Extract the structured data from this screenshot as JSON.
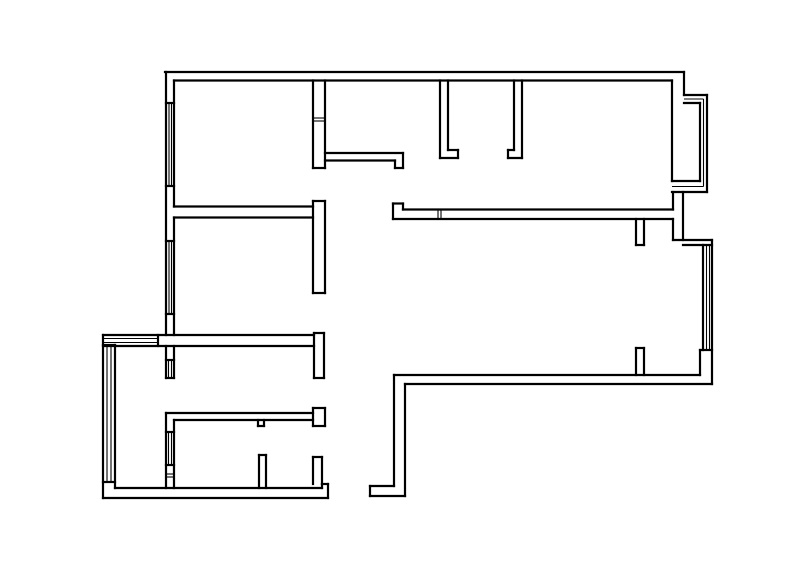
{
  "meta": {
    "description": "Residential apartment floor plan line drawing, black walls on white background",
    "background_color": "#ffffff"
  },
  "canvas": {
    "width": 800,
    "height": 563
  },
  "style": {
    "wall_color": "#000000",
    "wall_stroke_width": 2.2,
    "glazing_color": "#000000",
    "glazing_stroke_width": 1.1
  },
  "floor_plan": {
    "wall_segments": [
      [
        165,
        72,
        684,
        72
      ],
      [
        174,
        80.5,
        672,
        80.5
      ],
      [
        166,
        72,
        166,
        335
      ],
      [
        174,
        80.5,
        174,
        206.5
      ],
      [
        174,
        217.5,
        174,
        335
      ],
      [
        166,
        103,
        174,
        103
      ],
      [
        166,
        186,
        174,
        186
      ],
      [
        166,
        241,
        174,
        241
      ],
      [
        166,
        314,
        174,
        314
      ],
      [
        174,
        206.5,
        313,
        206.5
      ],
      [
        174,
        217.5,
        313,
        217.5
      ],
      [
        313,
        201,
        313,
        293
      ],
      [
        325,
        201,
        325,
        293
      ],
      [
        313,
        201,
        325,
        201
      ],
      [
        313,
        293,
        325,
        293
      ],
      [
        313,
        80.5,
        313,
        168
      ],
      [
        325,
        80.5,
        325,
        168
      ],
      [
        313,
        168,
        325,
        168
      ],
      [
        325,
        153,
        403,
        153
      ],
      [
        325,
        160.5,
        395,
        160.5
      ],
      [
        395,
        160.5,
        395,
        168
      ],
      [
        395,
        168,
        403,
        168
      ],
      [
        403,
        153,
        403,
        168
      ],
      [
        440,
        80.5,
        440,
        158
      ],
      [
        448,
        80.5,
        448,
        150
      ],
      [
        448,
        150,
        458,
        150
      ],
      [
        458,
        150,
        458,
        158
      ],
      [
        440,
        158,
        458,
        158
      ],
      [
        522,
        80.5,
        522,
        158
      ],
      [
        514,
        80.5,
        514,
        150
      ],
      [
        508,
        150,
        514,
        150
      ],
      [
        508,
        150,
        508,
        158
      ],
      [
        508,
        158,
        522,
        158
      ],
      [
        393,
        203.5,
        403,
        203.5
      ],
      [
        393,
        203.5,
        393,
        219
      ],
      [
        403,
        203.5,
        403,
        209.5
      ],
      [
        403,
        209.5,
        673,
        209.5
      ],
      [
        393,
        219,
        673,
        219
      ],
      [
        636,
        219,
        636,
        245
      ],
      [
        644,
        219,
        644,
        245
      ],
      [
        636,
        245,
        644,
        245
      ],
      [
        684,
        72,
        684,
        95
      ],
      [
        672,
        80.5,
        672,
        181
      ],
      [
        684,
        95,
        707,
        95
      ],
      [
        707,
        95,
        707,
        192
      ],
      [
        672,
        192,
        707,
        192
      ],
      [
        684,
        103,
        700,
        103
      ],
      [
        700,
        103,
        700,
        181
      ],
      [
        672,
        181,
        700,
        181
      ],
      [
        673,
        192,
        673,
        209.5
      ],
      [
        673,
        219,
        673,
        240
      ],
      [
        683,
        192,
        683,
        240
      ],
      [
        673,
        240,
        712,
        240
      ],
      [
        683,
        245,
        712,
        245
      ],
      [
        712,
        240,
        712,
        384
      ],
      [
        703,
        245,
        703,
        350
      ],
      [
        700,
        350,
        712,
        350
      ],
      [
        700,
        350,
        700,
        375
      ],
      [
        394,
        375,
        700,
        375
      ],
      [
        405,
        384,
        712,
        384
      ],
      [
        636,
        348,
        636,
        375
      ],
      [
        644,
        348,
        644,
        375
      ],
      [
        636,
        348,
        644,
        348
      ],
      [
        394,
        375,
        394,
        486
      ],
      [
        405,
        384,
        405,
        496
      ],
      [
        370,
        486,
        394,
        486
      ],
      [
        370,
        496,
        405,
        496
      ],
      [
        370,
        486,
        370,
        496
      ],
      [
        103,
        335,
        314,
        335
      ],
      [
        103,
        346,
        314,
        346
      ],
      [
        158,
        335,
        158,
        346
      ],
      [
        314,
        333,
        314,
        378
      ],
      [
        324,
        333,
        324,
        378
      ],
      [
        314,
        333,
        324,
        333
      ],
      [
        314,
        378,
        324,
        378
      ],
      [
        166,
        346,
        166,
        378
      ],
      [
        174,
        346,
        174,
        378
      ],
      [
        166,
        360,
        174,
        360
      ],
      [
        166,
        378,
        174,
        378
      ],
      [
        103,
        335,
        103,
        498
      ],
      [
        115,
        345,
        115,
        488
      ],
      [
        103,
        345,
        115,
        345
      ],
      [
        103,
        482,
        115,
        482
      ],
      [
        103,
        498,
        328,
        498
      ],
      [
        115,
        488,
        322,
        488
      ],
      [
        322,
        484,
        328,
        484
      ],
      [
        322,
        484,
        322,
        488
      ],
      [
        328,
        484,
        328,
        498
      ],
      [
        259,
        455,
        259,
        488
      ],
      [
        266,
        455,
        266,
        488
      ],
      [
        259,
        455,
        266,
        455
      ],
      [
        313,
        457,
        313,
        484
      ],
      [
        322,
        457,
        322,
        484
      ],
      [
        313,
        457,
        322,
        457
      ],
      [
        166,
        413,
        313,
        413
      ],
      [
        174,
        420,
        313,
        420
      ],
      [
        166,
        413,
        166,
        488
      ],
      [
        174,
        420,
        174,
        488
      ],
      [
        166,
        432,
        174,
        432
      ],
      [
        166,
        465,
        174,
        465
      ],
      [
        258,
        420,
        258,
        426
      ],
      [
        264,
        420,
        264,
        426
      ],
      [
        258,
        426,
        264,
        426
      ],
      [
        313,
        408,
        313,
        426
      ],
      [
        325,
        408,
        325,
        426
      ],
      [
        313,
        408,
        325,
        408
      ],
      [
        313,
        426,
        325,
        426
      ]
    ],
    "glazing_segments": [
      [
        169,
        103,
        169,
        186
      ],
      [
        171.5,
        103,
        171.5,
        186
      ],
      [
        169,
        241,
        169,
        314
      ],
      [
        171.5,
        241,
        171.5,
        314
      ],
      [
        313,
        118,
        325,
        118
      ],
      [
        313,
        121,
        325,
        121
      ],
      [
        438,
        209.5,
        438,
        219
      ],
      [
        441,
        209.5,
        441,
        219
      ],
      [
        684,
        99,
        703.5,
        99
      ],
      [
        703.5,
        99,
        703.5,
        186.5
      ],
      [
        672,
        186.5,
        703.5,
        186.5
      ],
      [
        706.5,
        245,
        706.5,
        350
      ],
      [
        709.5,
        245,
        709.5,
        350
      ],
      [
        103,
        338.5,
        158,
        338.5
      ],
      [
        103,
        342.5,
        158,
        342.5
      ],
      [
        168.5,
        360,
        168.5,
        378
      ],
      [
        171.5,
        360,
        171.5,
        378
      ],
      [
        107,
        345,
        107,
        482
      ],
      [
        111,
        345,
        111,
        482
      ],
      [
        168.5,
        432,
        168.5,
        465
      ],
      [
        171.5,
        432,
        171.5,
        465
      ],
      [
        166,
        474,
        174,
        474
      ],
      [
        166,
        477,
        174,
        477
      ]
    ]
  }
}
